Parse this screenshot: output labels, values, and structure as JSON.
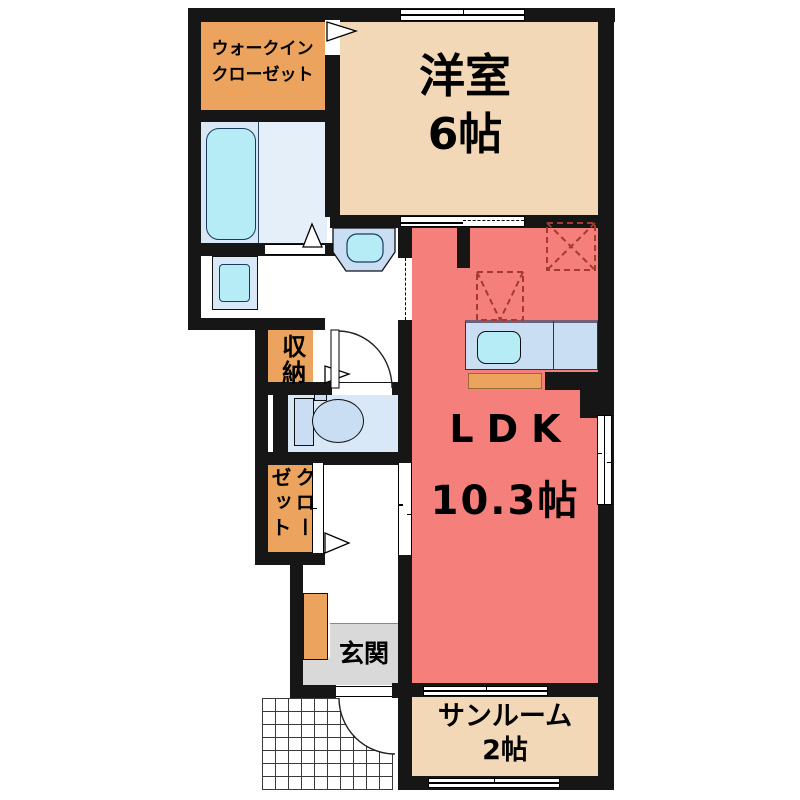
{
  "rooms": {
    "wic": {
      "line1": "ウォークイン",
      "line2": "クローゼット"
    },
    "western": {
      "name": "洋室",
      "size": "6帖"
    },
    "ldk": {
      "name": "LDK",
      "size": "10.3帖"
    },
    "sunroom": {
      "name": "サンルーム",
      "size": "2帖"
    },
    "storage": {
      "name": "収納"
    },
    "closet": {
      "name": "クローゼット"
    },
    "entrance": {
      "name": "玄関"
    }
  },
  "colors": {
    "wall": "#161616",
    "orange": "#ECA35D",
    "beige": "#F3D8B8",
    "red": "#F5807B",
    "bathfloor": "#D9E8F7",
    "bathfloor2": "#E4EFFA",
    "fixture": "#C9DDF3",
    "cyan": "#B6ECF6",
    "gray": "#D9D9D9",
    "dash": "#A33B2E"
  },
  "fixtures": {
    "bathtub": "bathtub",
    "washing_machine_pan": "washing-machine-pan",
    "washbasin": "washbasin",
    "toilet": "toilet",
    "kitchen_counter": "kitchen-counter",
    "kitchen_sink": "kitchen-sink",
    "refrigerator_space": "refrigerator-space-dashed",
    "appliance_space": "appliance-space-dashed",
    "shoe_cabinet": "shoe-cabinet",
    "entrance_door": "entrance-door",
    "porch_tiles": "porch-tiles"
  }
}
